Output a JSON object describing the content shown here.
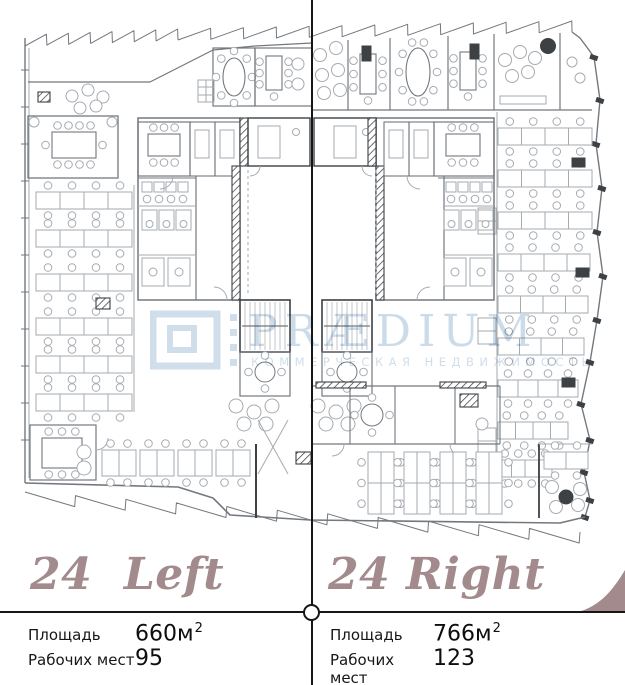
{
  "watermark": {
    "brand": "PRÆDIUM",
    "tagline": "КОММЕРЧЕСКАЯ НЕДВИЖИМОСТЬ"
  },
  "sections": {
    "left": {
      "title": "24  Left",
      "area_label": "Площадь",
      "area_value": "660м",
      "area_sup": "2",
      "seats_label": "Рабочих мест",
      "seats_value": "95"
    },
    "right": {
      "title": "24 Right",
      "area_label": "Площадь",
      "area_value": "766м",
      "area_sup": "2",
      "seats_label": "Рабочих мест",
      "seats_value": "123"
    }
  },
  "colors": {
    "accent": "#a28a8d",
    "line": "#161616",
    "watermark": "#a9c4da",
    "plan-light": "#a6abb0",
    "plan-mid": "#73787e",
    "plan-dark": "#3d4144"
  }
}
